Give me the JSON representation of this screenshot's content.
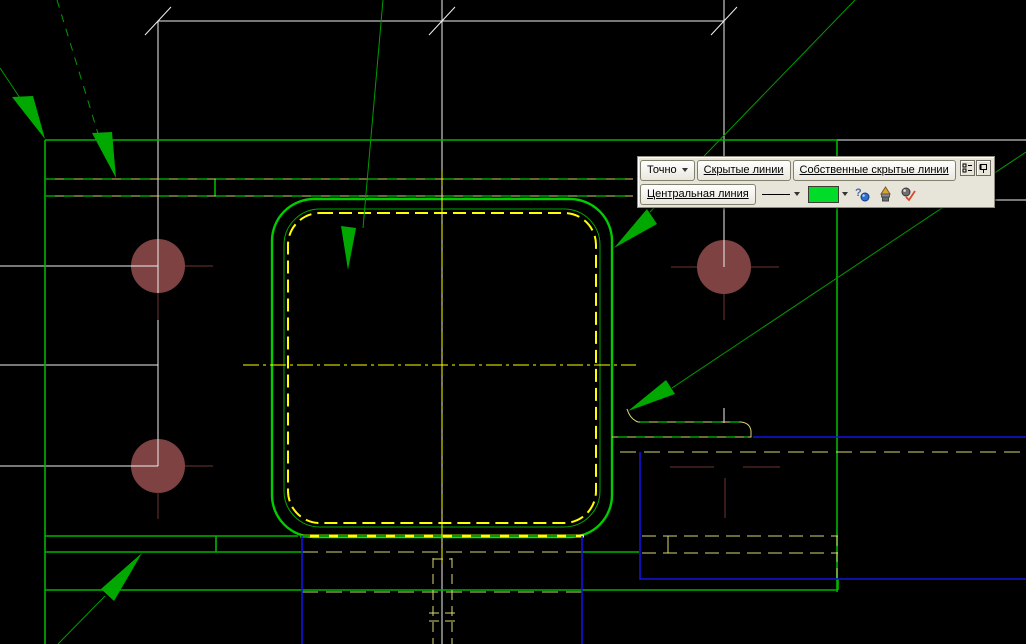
{
  "app": {
    "type": "cad-drawing-view",
    "language": "ru"
  },
  "palette": {
    "background": "#000000",
    "white_line": "#f0f0f0",
    "green_body": "#00b400",
    "green_bright": "#00cc00",
    "green_dark_dash": "#00a000",
    "green_leader": "#009c00",
    "green_arrow_fill": "#00a800",
    "yellow_bright": "#ffff00",
    "yellow_pale": "#d8d875",
    "yellow_flange": "#cfcf6e",
    "blue_line": "#1212e0",
    "brown_circle": "#7f4242",
    "brown_axis": "#6e3434",
    "toolbar_bg": "#e7e4da",
    "toolbar_border": "#8f8d82",
    "button_face": "#f6f5ef",
    "button_border": "#82806e",
    "swatch_green": "#00dc28"
  },
  "toolbar": {
    "precision": {
      "label": "Точно",
      "icon": "dropdown-arrow"
    },
    "buttons": [
      {
        "label": "Скрытые линии"
      },
      {
        "label": "Собственные скрытые линии"
      }
    ],
    "row2": {
      "layer_button": {
        "label": "Центральная линия"
      },
      "linestyle_dropdown": {
        "selected": "solid-thin-line"
      },
      "color_swatch": {
        "selected_color": "#00dc28"
      },
      "icons": [
        {
          "name": "help-query-icon"
        },
        {
          "name": "brush-icon"
        },
        {
          "name": "apply-check-icon"
        }
      ]
    },
    "window_buttons": [
      {
        "name": "properties-icon"
      },
      {
        "name": "pin-icon"
      }
    ]
  }
}
